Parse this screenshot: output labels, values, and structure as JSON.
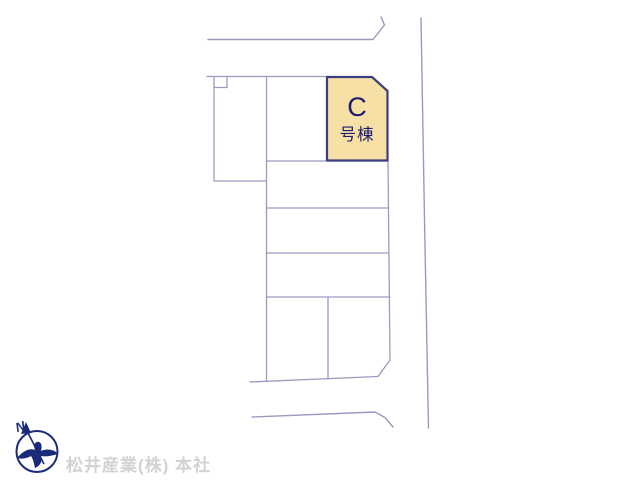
{
  "page": {
    "background_color": "#ffffff",
    "type_note": "real-estate site plan (lot layout drawing)"
  },
  "site_plan": {
    "highlighted_lot": {
      "letter": "C",
      "suffix_label": "号棟",
      "fill_color": "#f7e0a5",
      "border_color": "#3e3e7e",
      "text_color": "#1c1c70"
    },
    "lot_line_color": "#9a9ac0",
    "road_line_color": "#9a9ac0"
  },
  "compass": {
    "north_label": "N",
    "logo_color": "#1b2b7a"
  },
  "footer": {
    "company_name": "松井産業(株) 本社",
    "text_color": "#d2d2d2"
  }
}
